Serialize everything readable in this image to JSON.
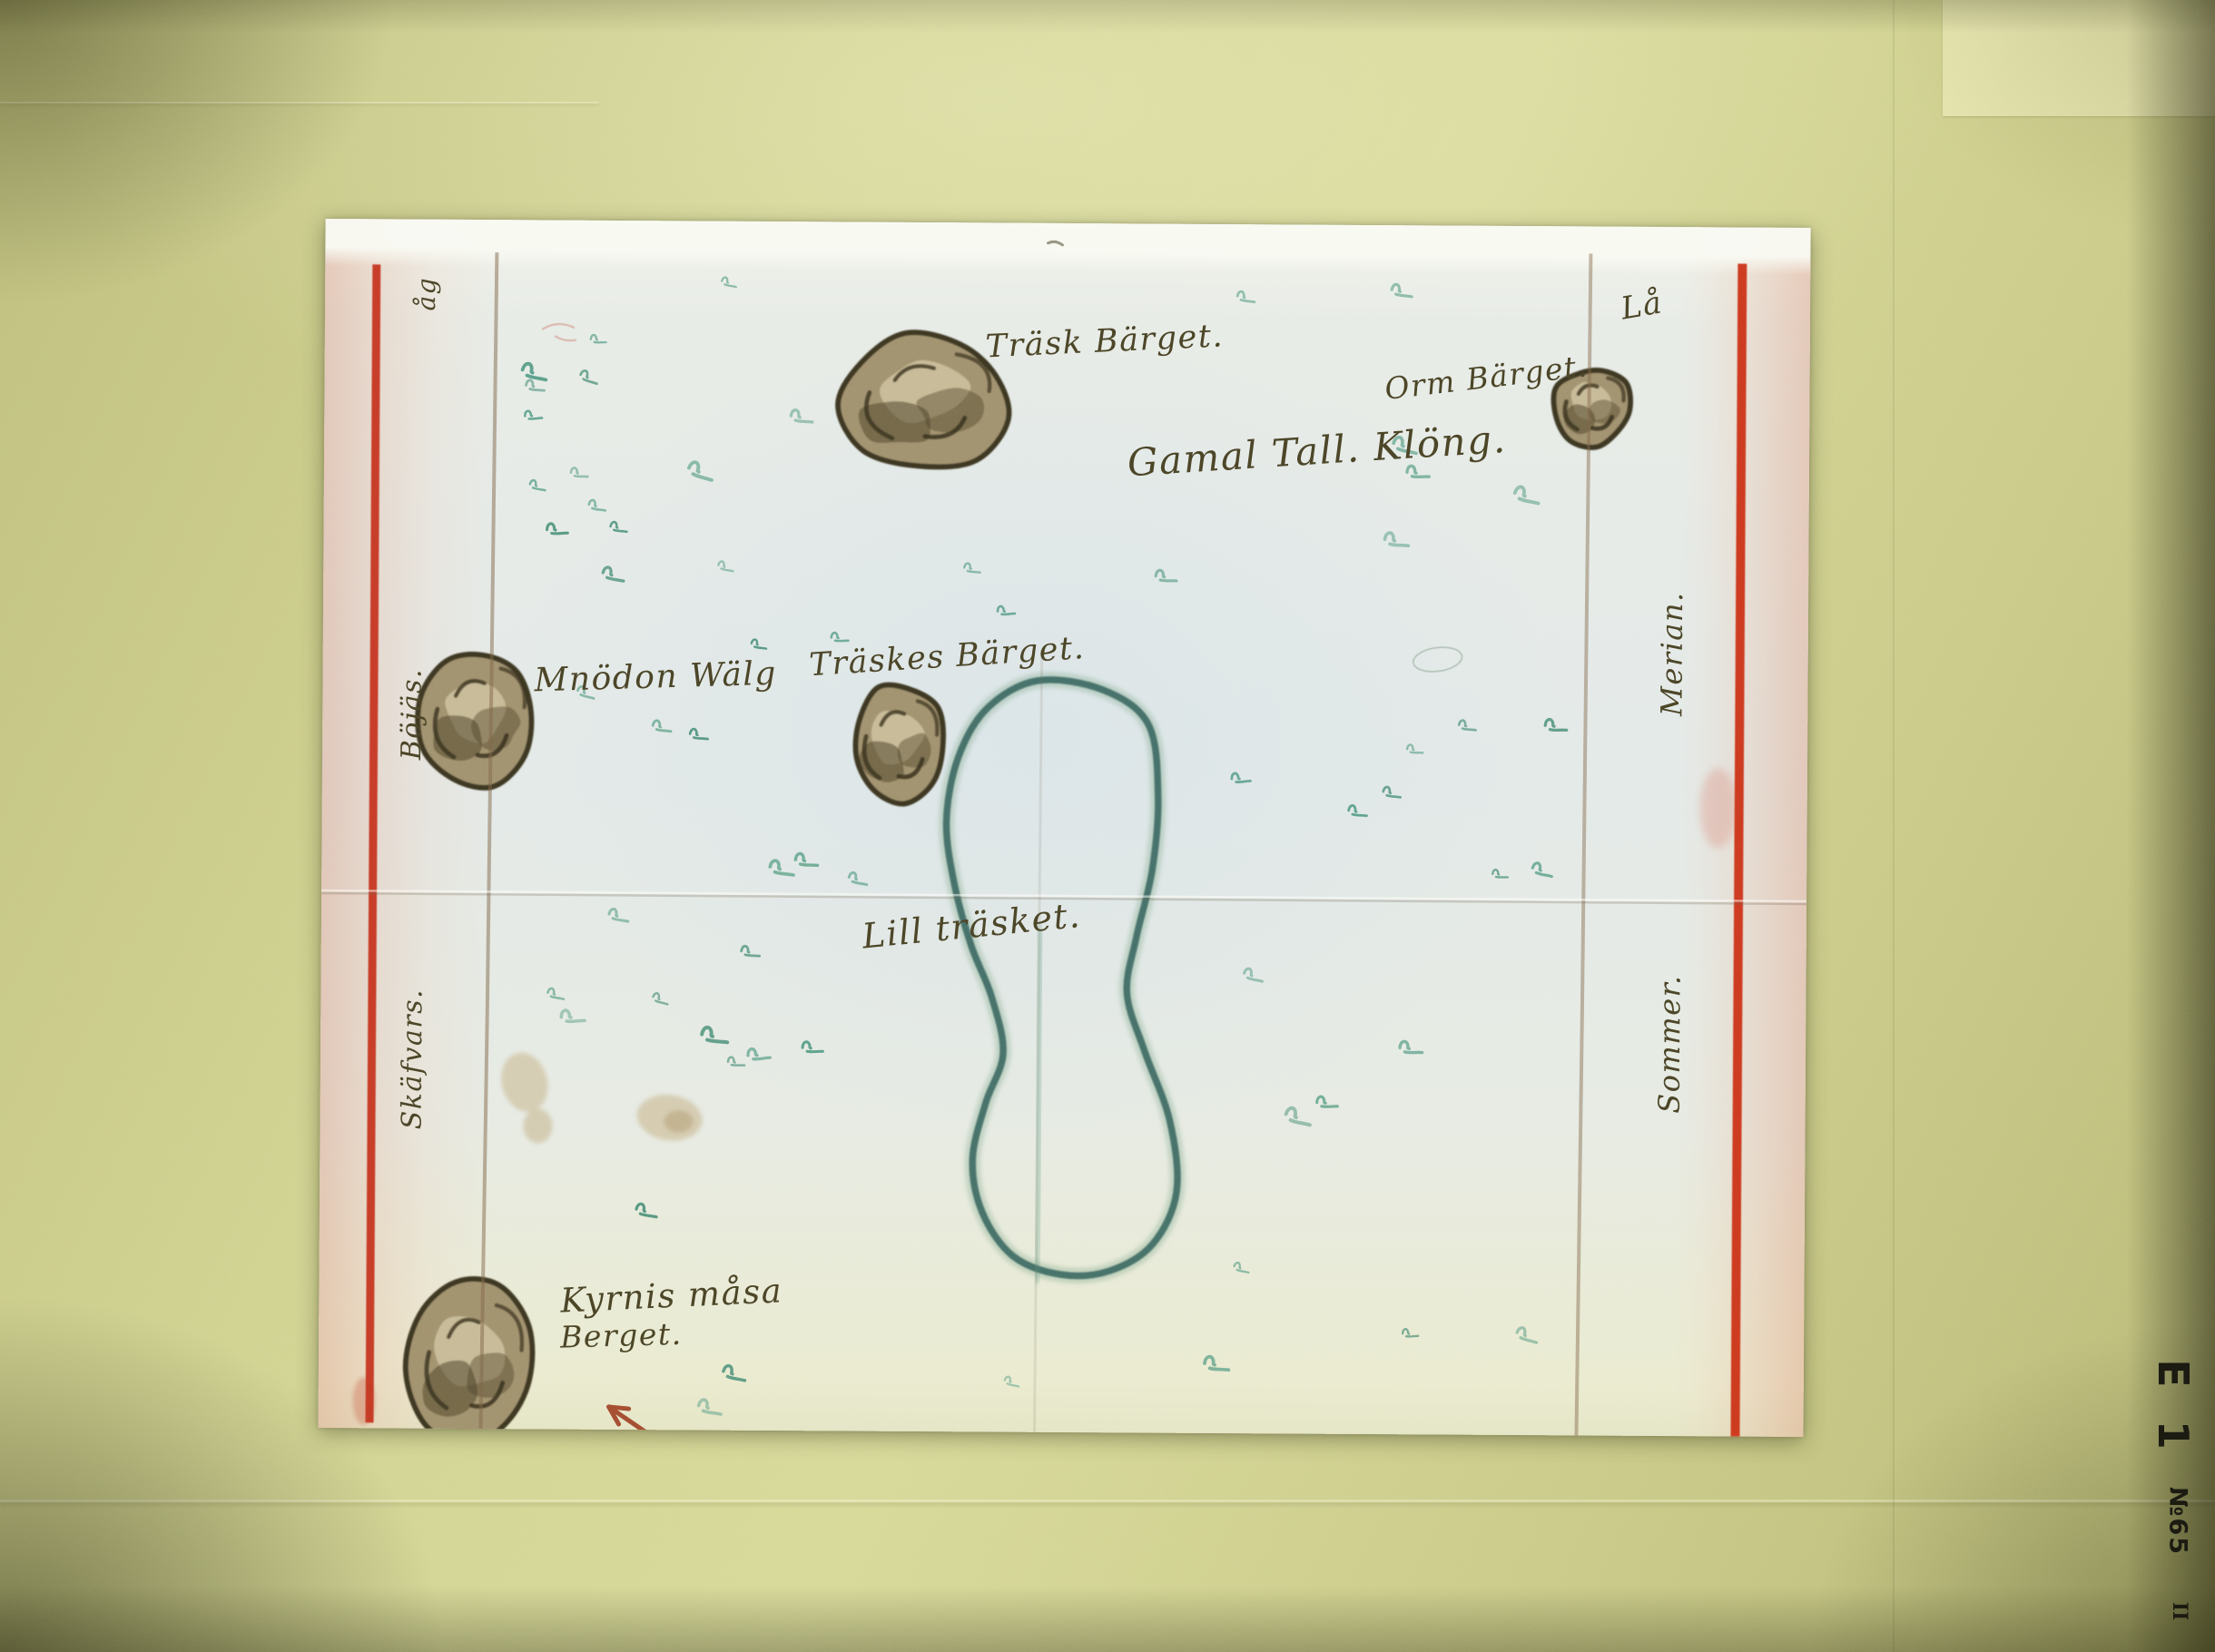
{
  "photo": {
    "background_color": "#cfd18f",
    "stamp": {
      "series": "E 1",
      "number": "№65",
      "suffix": "II"
    }
  },
  "map": {
    "ink_color": "#4b4527",
    "red_line_color": "#c5301b",
    "lake_color": "#3e6b63",
    "lake_halo_color": "#86ad92",
    "grass_color": "#4f9a82",
    "rock_body_color": "#a1916c",
    "rock_light_color": "#cfc2a0",
    "rock_dark_color": "#4f452b",
    "rock_line_color": "#39321e",
    "labels": {
      "trask_barget": "Träsk Bärget.",
      "gamal_tall_klong": "Gamal Tall. Klöng.",
      "orm_barget": "Orm Bärget.",
      "mnodon_walg": "Mnödon Wälg",
      "traskes_barget": "Träskes Bärget.",
      "lill_trasket": "Lill träsket.",
      "kyrnis_masa_line1": "Kyrnis måsa",
      "kyrnis_masa_line2": "Berget.",
      "corner_top_left": "åg",
      "corner_top_right": "Lå",
      "margin_left_upper": "Böjäs.",
      "margin_left_lower": "Skäfvars.",
      "margin_right_upper": "Merian.",
      "margin_right_lower": "Sommer."
    }
  }
}
